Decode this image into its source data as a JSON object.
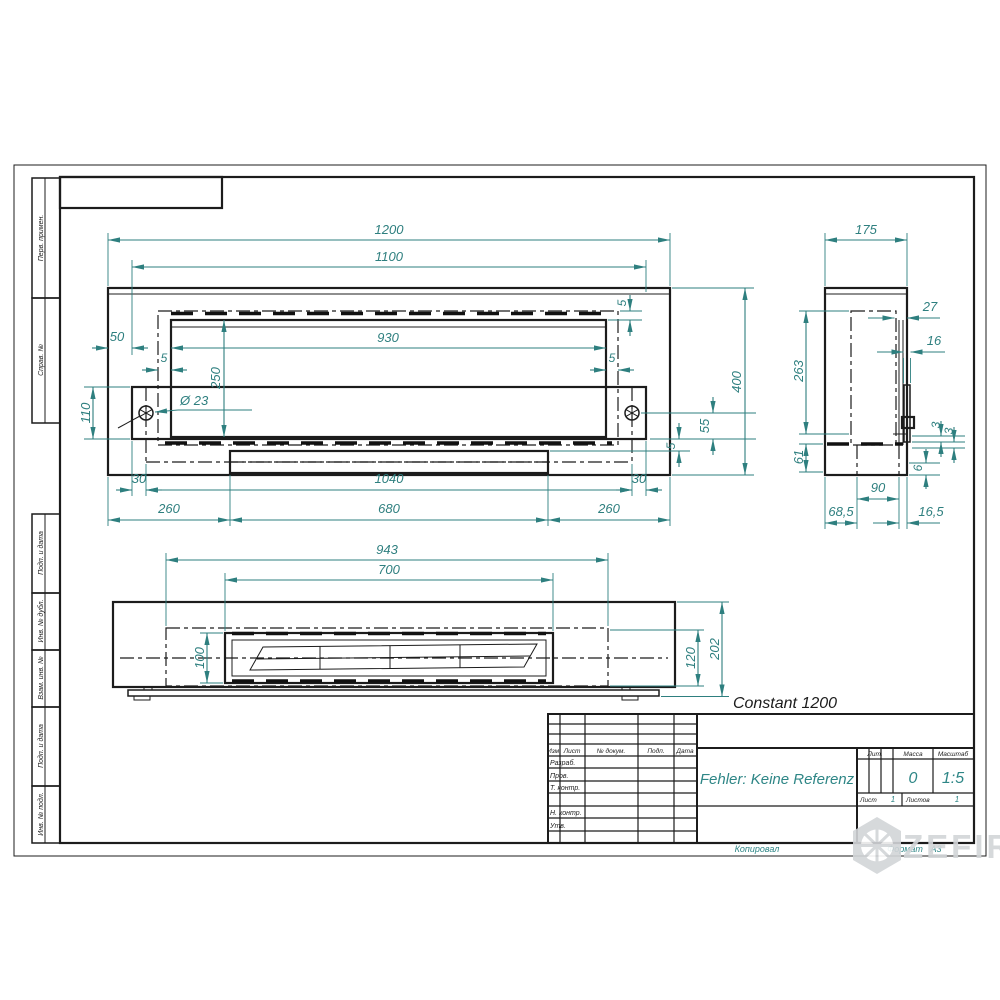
{
  "drawing_title": "Constant 1200",
  "footer": {
    "kopiroval": "Копировал",
    "format_label": "Формат",
    "format_value": "A3"
  },
  "watermark": {
    "text": "ZEFIRE"
  },
  "colors": {
    "dimension": "#2e7f7f",
    "line": "#1c1c1c",
    "teal_text": "#2e8686",
    "watermark": "#d2d5d8"
  },
  "margin_labels": {
    "perv": "Перв. примен.",
    "sprav": "Справ. №",
    "podp1": "Подп. и дата",
    "inv_dubl": "Инв. № дубл.",
    "vzam": "Взам. инв. №",
    "podp2": "Подп. и дата",
    "inv_podl": "Инв. № подл."
  },
  "title_block": {
    "name": "Fehler: Keine Referenz",
    "mass_value": "0",
    "scale_value": "1:5",
    "sheet_value": "1",
    "sheets_value": "1",
    "headers": {
      "izm": "Изм.",
      "list": "Лист",
      "doc": "№ докум.",
      "podp": "Подп.",
      "data": "Дата",
      "lit": "Лит.",
      "massa": "Масса",
      "masshtab": "Масштаб",
      "list2": "Лист",
      "listov": "Листов"
    },
    "rows": {
      "razrab": "Разраб.",
      "prov": "Пров.",
      "tkontr": "Т. контр.",
      "nkontr": "Н. контр.",
      "utv": "Утв."
    }
  },
  "dims": {
    "front": {
      "w1200": "1200",
      "w1100": "1100",
      "w930": "930",
      "h250": "250",
      "off50": "50",
      "g5l": "5",
      "g5r": "5",
      "g5t": "5",
      "dia": "Ø 23",
      "h110": "110",
      "h400": "400",
      "h55": "55",
      "g5b": "5",
      "i30l": "30",
      "w1040": "1040",
      "i30r": "30",
      "s260l": "260",
      "w680": "680",
      "s260r": "260"
    },
    "side": {
      "d175": "175",
      "t27": "27",
      "g16": "16",
      "h263": "263",
      "g3a": "3",
      "g3b": "3",
      "h61": "61",
      "d90": "90",
      "g6": "6",
      "o685": "68,5",
      "o165": "16,5"
    },
    "bottom": {
      "w943": "943",
      "w700": "700",
      "d100": "100",
      "d120": "120",
      "d202": "202"
    }
  }
}
